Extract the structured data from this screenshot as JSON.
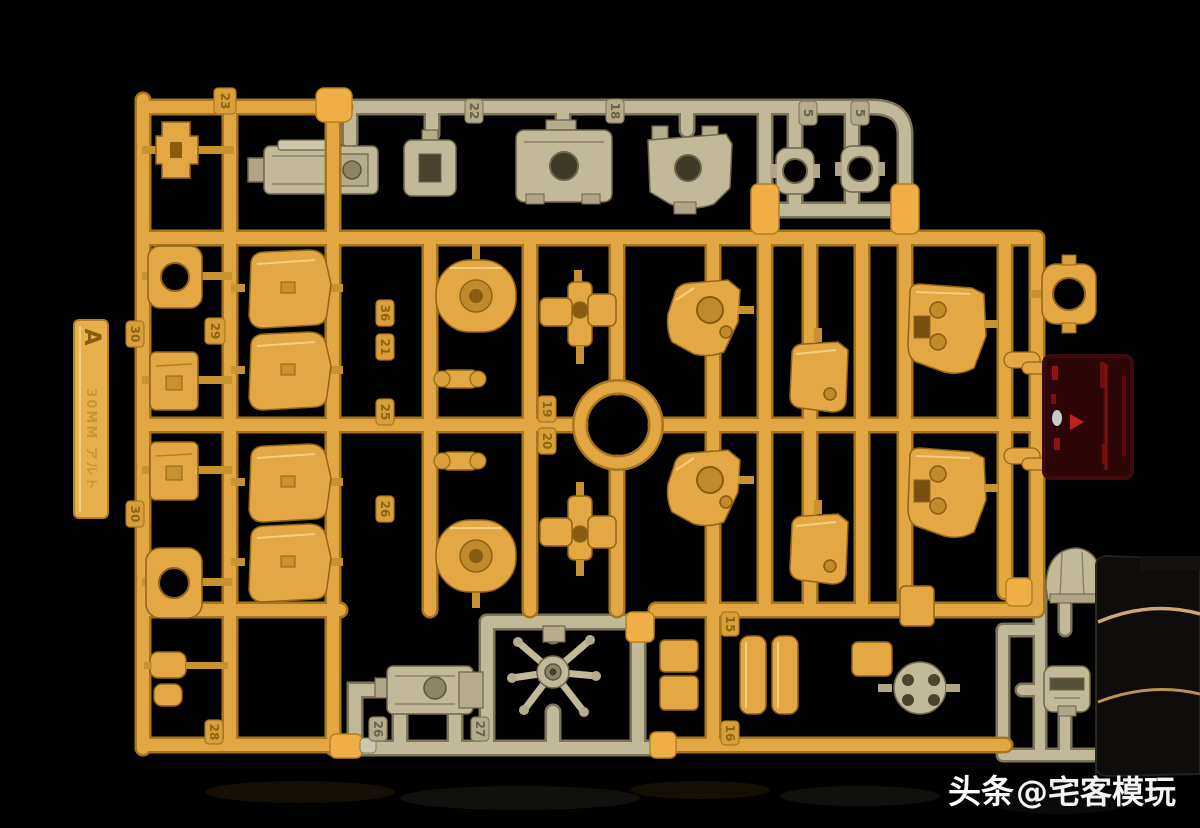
{
  "watermark": {
    "brand": "头条",
    "handle": "@宅客模玩"
  },
  "runner_tag": {
    "letter": "A",
    "molded_text": "30MM アルト"
  },
  "tabs": [
    "23",
    "29",
    "30",
    "30",
    "36",
    "21",
    "25",
    "26",
    "19",
    "20",
    "15",
    "16",
    "28",
    "26",
    "27",
    "22",
    "18",
    "5",
    "5"
  ],
  "colors": {
    "background": "#000000",
    "yellow_plastic": "#E2A642",
    "yellow_shadow": "#A8761F",
    "yellow_part": "#E3A743",
    "khaki_plastic": "#C2B999",
    "khaki_shadow": "#7E7659",
    "clear_red_part": "#2E0507",
    "red_glint": "#B81A1A",
    "watermark_text": "#FFFFFF"
  }
}
